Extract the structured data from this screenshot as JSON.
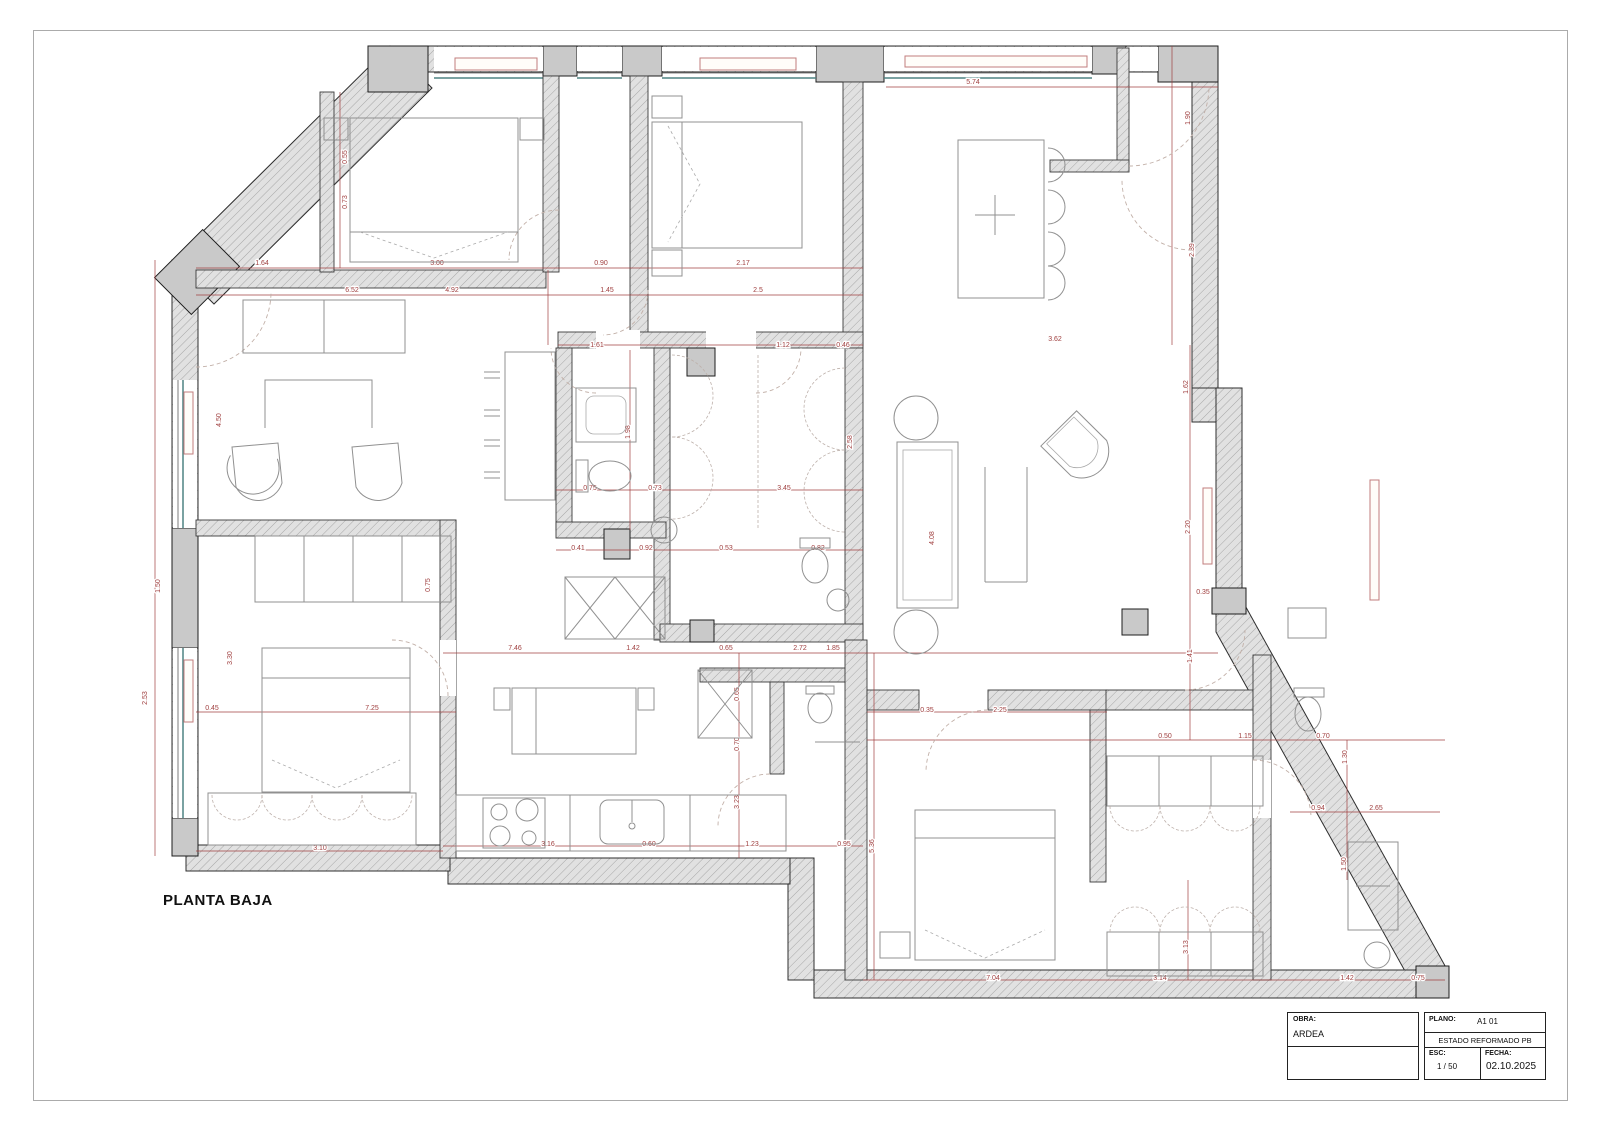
{
  "page": {
    "title": "PLANTA BAJA"
  },
  "title_block": {
    "obra_label": "OBRA:",
    "obra_value": "ARDEA",
    "plano_label": "PLANO:",
    "plano_value": "A1 01",
    "estado": "ESTADO REFORMADO PB",
    "esc_label": "ESC:",
    "esc_value": "1 / 50",
    "fecha_label": "FECHA:",
    "fecha_value": "02.10.2025"
  },
  "colors": {
    "dimension_red": "#a04040",
    "wall_gray": "#dcdcdc",
    "pier_gray": "#c9c9c9",
    "window_teal": "#4e8484",
    "radiator_pink": "#c27d7d"
  },
  "dimensions": [
    {
      "v": "1.64",
      "x": 262,
      "y": 265
    },
    {
      "v": "3.00",
      "x": 437,
      "y": 265
    },
    {
      "v": "0.90",
      "x": 601,
      "y": 265
    },
    {
      "v": "2.17",
      "x": 743,
      "y": 265
    },
    {
      "v": "6.52",
      "x": 352,
      "y": 292
    },
    {
      "v": "4.92",
      "x": 452,
      "y": 292
    },
    {
      "v": "1.45",
      "x": 607,
      "y": 292
    },
    {
      "v": "2.5",
      "x": 758,
      "y": 292
    },
    {
      "v": "5.74",
      "x": 973,
      "y": 84
    },
    {
      "v": "1.90",
      "x": 1190,
      "y": 118,
      "r": 90
    },
    {
      "v": "2.39",
      "x": 1194,
      "y": 250,
      "r": 90
    },
    {
      "v": "0.55",
      "x": 347,
      "y": 157,
      "r": 90
    },
    {
      "v": "0.73",
      "x": 347,
      "y": 202,
      "r": 90
    },
    {
      "v": "4.50",
      "x": 221,
      "y": 420,
      "r": 90
    },
    {
      "v": "1.50",
      "x": 160,
      "y": 586,
      "r": 90
    },
    {
      "v": "2.53",
      "x": 147,
      "y": 698,
      "r": 90
    },
    {
      "v": "3.30",
      "x": 232,
      "y": 658,
      "r": 90
    },
    {
      "v": "0.75",
      "x": 430,
      "y": 585,
      "r": 90
    },
    {
      "v": "1.61",
      "x": 597,
      "y": 347
    },
    {
      "v": "1.12",
      "x": 783,
      "y": 347
    },
    {
      "v": "0.46",
      "x": 843,
      "y": 347
    },
    {
      "v": "1.98",
      "x": 630,
      "y": 432,
      "r": 90
    },
    {
      "v": "2.58",
      "x": 852,
      "y": 442,
      "r": 90
    },
    {
      "v": "0.75",
      "x": 590,
      "y": 490
    },
    {
      "v": "0.73",
      "x": 655,
      "y": 490
    },
    {
      "v": "3.45",
      "x": 784,
      "y": 490
    },
    {
      "v": "0.41",
      "x": 578,
      "y": 550
    },
    {
      "v": "0.92",
      "x": 646,
      "y": 550
    },
    {
      "v": "0.53",
      "x": 726,
      "y": 550
    },
    {
      "v": "0.82",
      "x": 818,
      "y": 550
    },
    {
      "v": "3.62",
      "x": 1055,
      "y": 341
    },
    {
      "v": "1.62",
      "x": 1188,
      "y": 387,
      "r": 90
    },
    {
      "v": "2.20",
      "x": 1190,
      "y": 527,
      "r": 90
    },
    {
      "v": "0.35",
      "x": 1203,
      "y": 594
    },
    {
      "v": "4.08",
      "x": 934,
      "y": 538,
      "r": 90
    },
    {
      "v": "1.41",
      "x": 1192,
      "y": 656,
      "r": 90
    },
    {
      "v": "7.46",
      "x": 515,
      "y": 650
    },
    {
      "v": "1.42",
      "x": 633,
      "y": 650
    },
    {
      "v": "0.65",
      "x": 726,
      "y": 650
    },
    {
      "v": "2.72",
      "x": 800,
      "y": 650
    },
    {
      "v": "1.85",
      "x": 833,
      "y": 650
    },
    {
      "v": "0.65",
      "x": 739,
      "y": 694,
      "r": 90
    },
    {
      "v": "0.70",
      "x": 739,
      "y": 744,
      "r": 90
    },
    {
      "v": "3.23",
      "x": 739,
      "y": 802,
      "r": 90
    },
    {
      "v": "3.16",
      "x": 548,
      "y": 846
    },
    {
      "v": "0.60",
      "x": 649,
      "y": 846
    },
    {
      "v": "1.23",
      "x": 752,
      "y": 846
    },
    {
      "v": "0.95",
      "x": 844,
      "y": 846
    },
    {
      "v": "5.36",
      "x": 874,
      "y": 846,
      "r": 90
    },
    {
      "v": "3.10",
      "x": 320,
      "y": 850
    },
    {
      "v": "0.45",
      "x": 212,
      "y": 710
    },
    {
      "v": "7.25",
      "x": 372,
      "y": 710
    },
    {
      "v": "0.35",
      "x": 927,
      "y": 712
    },
    {
      "v": "2.25",
      "x": 1000,
      "y": 712
    },
    {
      "v": "0.50",
      "x": 1165,
      "y": 738
    },
    {
      "v": "1.15",
      "x": 1245,
      "y": 738
    },
    {
      "v": "0.70",
      "x": 1323,
      "y": 738
    },
    {
      "v": "1.30",
      "x": 1347,
      "y": 757,
      "r": 90
    },
    {
      "v": "0.94",
      "x": 1318,
      "y": 810
    },
    {
      "v": "2.65",
      "x": 1376,
      "y": 810
    },
    {
      "v": "1.50",
      "x": 1346,
      "y": 864,
      "r": 90
    },
    {
      "v": "3.13",
      "x": 1188,
      "y": 947,
      "r": 90
    },
    {
      "v": "7.04",
      "x": 993,
      "y": 980
    },
    {
      "v": "3.14",
      "x": 1160,
      "y": 980
    },
    {
      "v": "1.42",
      "x": 1347,
      "y": 980
    },
    {
      "v": "0.75",
      "x": 1418,
      "y": 980
    }
  ]
}
